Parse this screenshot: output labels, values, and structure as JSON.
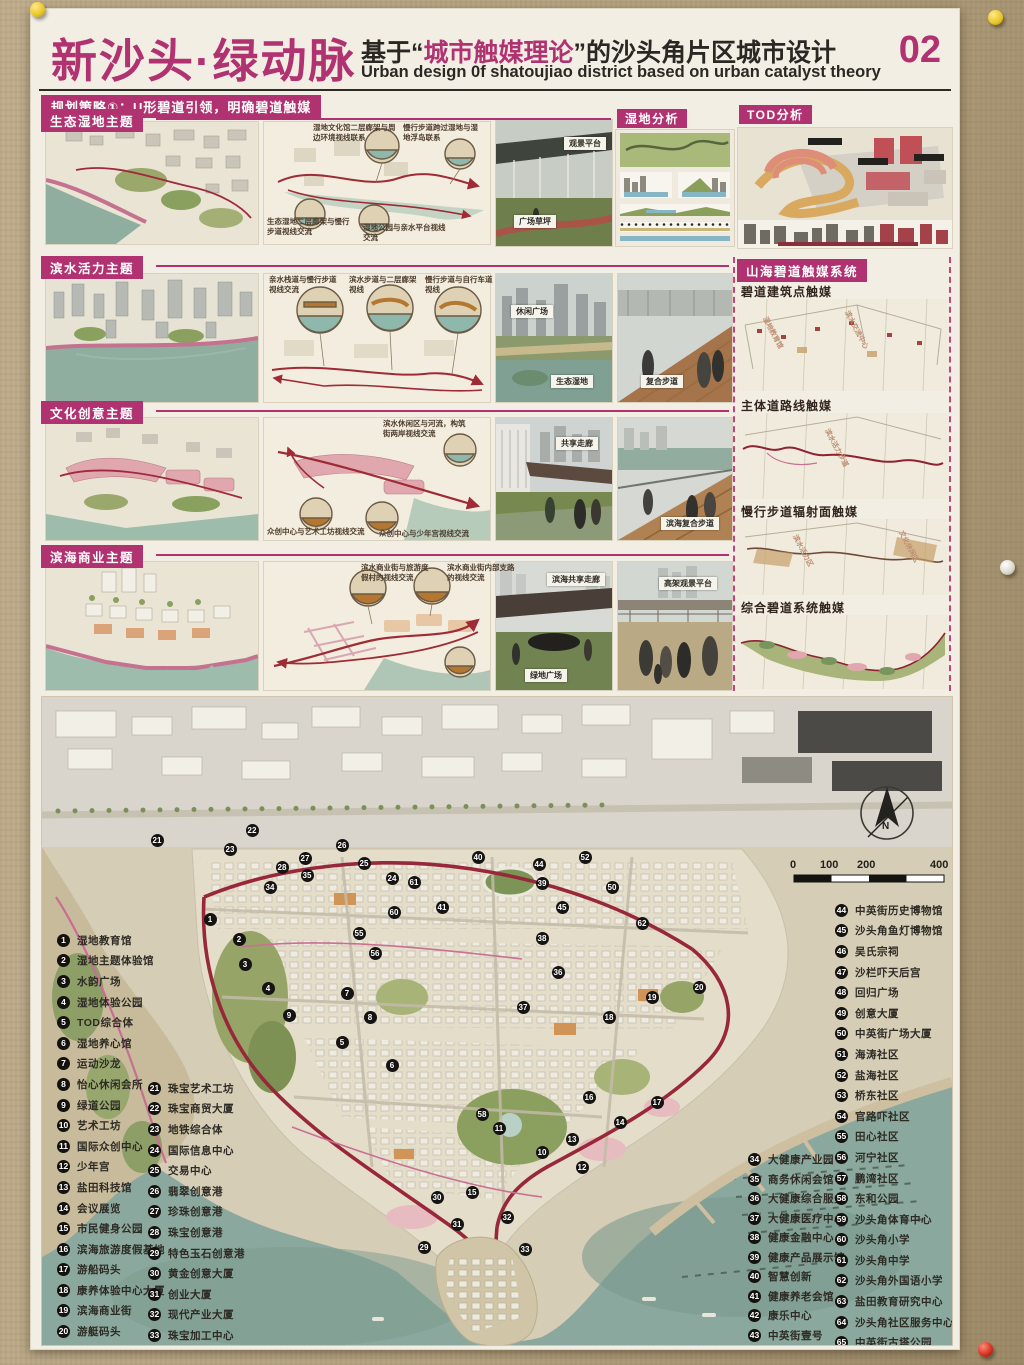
{
  "header": {
    "title": "新沙头·绿动脉",
    "sub_prefix": "基于“",
    "sub_highlight": "城市触媒理论",
    "sub_suffix": "”的沙头角片区城市设计",
    "sub_en": "Urban design 0f shatoujiao district based on urban catalyst theory",
    "page_no": "02"
  },
  "strategy": "规划策略①：U形碧道引领，明确碧道触媒",
  "rows": [
    {
      "tag": "生态湿地主题",
      "callouts": [
        "湿地文化馆二层廊架与周边环境视线联系",
        "慢行步道跨过湿地与湿地浮岛联系",
        "生态湿地二层廊架与慢行步道视线交流",
        "湿地公园与亲水平台视线交流"
      ],
      "photos": [
        "观景平台",
        "广场草坪"
      ]
    },
    {
      "tag": "滨水活力主题",
      "callouts": [
        "亲水栈道与慢行步道视线交流",
        "滨水步道与二层廊架视线",
        "慢行步道与自行车道视线"
      ],
      "photos": [
        "休闲广场",
        "生态湿地",
        "复合步道"
      ]
    },
    {
      "tag": "文化创意主题",
      "callouts": [
        "滨水休闲区与河流，构筑街两岸视线交流",
        "众创中心与艺术工坊视线交流",
        "众创中心与少年宫视线交流"
      ],
      "photos": [
        "共享走廊",
        "滨海复合步道"
      ]
    },
    {
      "tag": "滨海商业主题",
      "callouts": [
        "滨水商业街与旅游度假村的视线交流",
        "滨水商业街内部支路的视线交流"
      ],
      "photos": [
        "滨海共享走廊",
        "绿地广场",
        "高架观景平台"
      ]
    }
  ],
  "panels": {
    "wetland": "湿地分析",
    "tod": "TOD分析"
  },
  "catalyst": {
    "title": "山海碧道触媒系统",
    "sections": [
      "碧道建筑点触媒",
      "主体道路线触媒",
      "慢行步道辐射面触媒",
      "综合碧道系统触媒"
    ],
    "annotations": [
      "湿地教育馆",
      "滨水交流中心",
      "滨水活力步道",
      "滨水活力区",
      "文化休闲区"
    ]
  },
  "map": {
    "compass": "N",
    "scale_labels": [
      "0",
      "100",
      "200",
      "400"
    ],
    "legend1": [
      {
        "n": 1,
        "t": "湿地教育馆"
      },
      {
        "n": 2,
        "t": "湿地主题体验馆"
      },
      {
        "n": 3,
        "t": "水韵广场"
      },
      {
        "n": 4,
        "t": "湿地体验公园"
      },
      {
        "n": 5,
        "t": "TOD综合体"
      },
      {
        "n": 6,
        "t": "湿地养心馆"
      },
      {
        "n": 7,
        "t": "运动沙龙"
      },
      {
        "n": 8,
        "t": "怡心休闲会所"
      },
      {
        "n": 9,
        "t": "绿道公园"
      },
      {
        "n": 10,
        "t": "艺术工坊"
      },
      {
        "n": 11,
        "t": "国际众创中心"
      },
      {
        "n": 12,
        "t": "少年宫"
      },
      {
        "n": 13,
        "t": "盐田科技馆"
      },
      {
        "n": 14,
        "t": "会议展览"
      },
      {
        "n": 15,
        "t": "市民健身公园"
      },
      {
        "n": 16,
        "t": "滨海旅游度假基地"
      },
      {
        "n": 17,
        "t": "游船码头"
      },
      {
        "n": 18,
        "t": "康养体验中心大厦"
      },
      {
        "n": 19,
        "t": "滨海商业街"
      },
      {
        "n": 20,
        "t": "游艇码头"
      }
    ],
    "legend2": [
      {
        "n": 21,
        "t": "珠宝艺术工坊"
      },
      {
        "n": 22,
        "t": "珠宝商贸大厦"
      },
      {
        "n": 23,
        "t": "地铁综合体"
      },
      {
        "n": 24,
        "t": "国际信息中心"
      },
      {
        "n": 25,
        "t": "交易中心"
      },
      {
        "n": 26,
        "t": "翡翠创意港"
      },
      {
        "n": 27,
        "t": "珍珠创意港"
      },
      {
        "n": 28,
        "t": "珠宝创意港"
      },
      {
        "n": 29,
        "t": "特色玉石创意港"
      },
      {
        "n": 30,
        "t": "黄金创意大厦"
      },
      {
        "n": 31,
        "t": "创业大厦"
      },
      {
        "n": 32,
        "t": "现代产业大厦"
      },
      {
        "n": 33,
        "t": "珠宝加工中心"
      }
    ],
    "legend3": [
      {
        "n": 34,
        "t": "大健康产业园"
      },
      {
        "n": 35,
        "t": "商务休闲会馆"
      },
      {
        "n": 36,
        "t": "大健康综合服务"
      },
      {
        "n": 37,
        "t": "大健康医疗中心"
      },
      {
        "n": 38,
        "t": "健康金融中心"
      },
      {
        "n": 39,
        "t": "健康产品展示馆"
      },
      {
        "n": 40,
        "t": "智慧创新"
      },
      {
        "n": 41,
        "t": "健康养老会馆"
      },
      {
        "n": 42,
        "t": "康乐中心"
      },
      {
        "n": 43,
        "t": "中英街壹号"
      }
    ],
    "legend4": [
      {
        "n": 44,
        "t": "中英街历史博物馆"
      },
      {
        "n": 45,
        "t": "沙头角鱼灯博物馆"
      },
      {
        "n": 46,
        "t": "吴氏宗祠"
      },
      {
        "n": 47,
        "t": "沙栏吓天后宫"
      },
      {
        "n": 48,
        "t": "回归广场"
      },
      {
        "n": 49,
        "t": "创意大厦"
      },
      {
        "n": 50,
        "t": "中英街广场大厦"
      },
      {
        "n": 51,
        "t": "海涛社区"
      },
      {
        "n": 52,
        "t": "盐海社区"
      },
      {
        "n": 53,
        "t": "桥东社区"
      },
      {
        "n": 54,
        "t": "官路吓社区"
      },
      {
        "n": 55,
        "t": "田心社区"
      },
      {
        "n": 56,
        "t": "河宁社区"
      },
      {
        "n": 57,
        "t": "鹏湾社区"
      },
      {
        "n": 58,
        "t": "东和公园"
      },
      {
        "n": 59,
        "t": "沙头角体育中心"
      },
      {
        "n": 60,
        "t": "沙头角小学"
      },
      {
        "n": 61,
        "t": "沙头角中学"
      },
      {
        "n": 62,
        "t": "沙头角外国语小学"
      },
      {
        "n": 63,
        "t": "盐田教育研究中心"
      },
      {
        "n": 64,
        "t": "沙头角社区服务中心"
      },
      {
        "n": 65,
        "t": "中英街古塔公园"
      }
    ],
    "markers": [
      {
        "n": 21,
        "x": 115,
        "y": 143
      },
      {
        "n": 22,
        "x": 210,
        "y": 133
      },
      {
        "n": 23,
        "x": 188,
        "y": 152
      },
      {
        "n": 28,
        "x": 240,
        "y": 170
      },
      {
        "n": 27,
        "x": 263,
        "y": 161
      },
      {
        "n": 26,
        "x": 300,
        "y": 148
      },
      {
        "n": 25,
        "x": 322,
        "y": 166
      },
      {
        "n": 24,
        "x": 350,
        "y": 181
      },
      {
        "n": 34,
        "x": 228,
        "y": 190
      },
      {
        "n": 35,
        "x": 265,
        "y": 178
      },
      {
        "n": 1,
        "x": 168,
        "y": 222
      },
      {
        "n": 2,
        "x": 197,
        "y": 242
      },
      {
        "n": 3,
        "x": 203,
        "y": 267
      },
      {
        "n": 4,
        "x": 226,
        "y": 291
      },
      {
        "n": 9,
        "x": 247,
        "y": 318
      },
      {
        "n": 5,
        "x": 300,
        "y": 345
      },
      {
        "n": 6,
        "x": 350,
        "y": 368
      },
      {
        "n": 7,
        "x": 305,
        "y": 296
      },
      {
        "n": 8,
        "x": 328,
        "y": 320
      },
      {
        "n": 61,
        "x": 372,
        "y": 185
      },
      {
        "n": 60,
        "x": 352,
        "y": 215
      },
      {
        "n": 55,
        "x": 317,
        "y": 236
      },
      {
        "n": 56,
        "x": 333,
        "y": 256
      },
      {
        "n": 41,
        "x": 400,
        "y": 210
      },
      {
        "n": 40,
        "x": 436,
        "y": 160
      },
      {
        "n": 44,
        "x": 497,
        "y": 167
      },
      {
        "n": 39,
        "x": 500,
        "y": 186
      },
      {
        "n": 52,
        "x": 543,
        "y": 160
      },
      {
        "n": 45,
        "x": 520,
        "y": 210
      },
      {
        "n": 50,
        "x": 570,
        "y": 190
      },
      {
        "n": 62,
        "x": 600,
        "y": 226
      },
      {
        "n": 38,
        "x": 500,
        "y": 241
      },
      {
        "n": 36,
        "x": 516,
        "y": 275
      },
      {
        "n": 37,
        "x": 481,
        "y": 310
      },
      {
        "n": 18,
        "x": 567,
        "y": 320
      },
      {
        "n": 19,
        "x": 610,
        "y": 300
      },
      {
        "n": 20,
        "x": 657,
        "y": 290
      },
      {
        "n": 16,
        "x": 547,
        "y": 400
      },
      {
        "n": 17,
        "x": 615,
        "y": 405
      },
      {
        "n": 58,
        "x": 440,
        "y": 417
      },
      {
        "n": 11,
        "x": 457,
        "y": 431
      },
      {
        "n": 13,
        "x": 530,
        "y": 442
      },
      {
        "n": 14,
        "x": 578,
        "y": 425
      },
      {
        "n": 10,
        "x": 500,
        "y": 455
      },
      {
        "n": 12,
        "x": 540,
        "y": 470
      },
      {
        "n": 15,
        "x": 430,
        "y": 495
      },
      {
        "n": 30,
        "x": 395,
        "y": 500
      },
      {
        "n": 31,
        "x": 415,
        "y": 527
      },
      {
        "n": 29,
        "x": 382,
        "y": 550
      },
      {
        "n": 32,
        "x": 465,
        "y": 520
      },
      {
        "n": 33,
        "x": 483,
        "y": 552
      }
    ]
  },
  "colors": {
    "accent": "#b13271",
    "route": "#98273a",
    "sea": "#8aa89d"
  }
}
